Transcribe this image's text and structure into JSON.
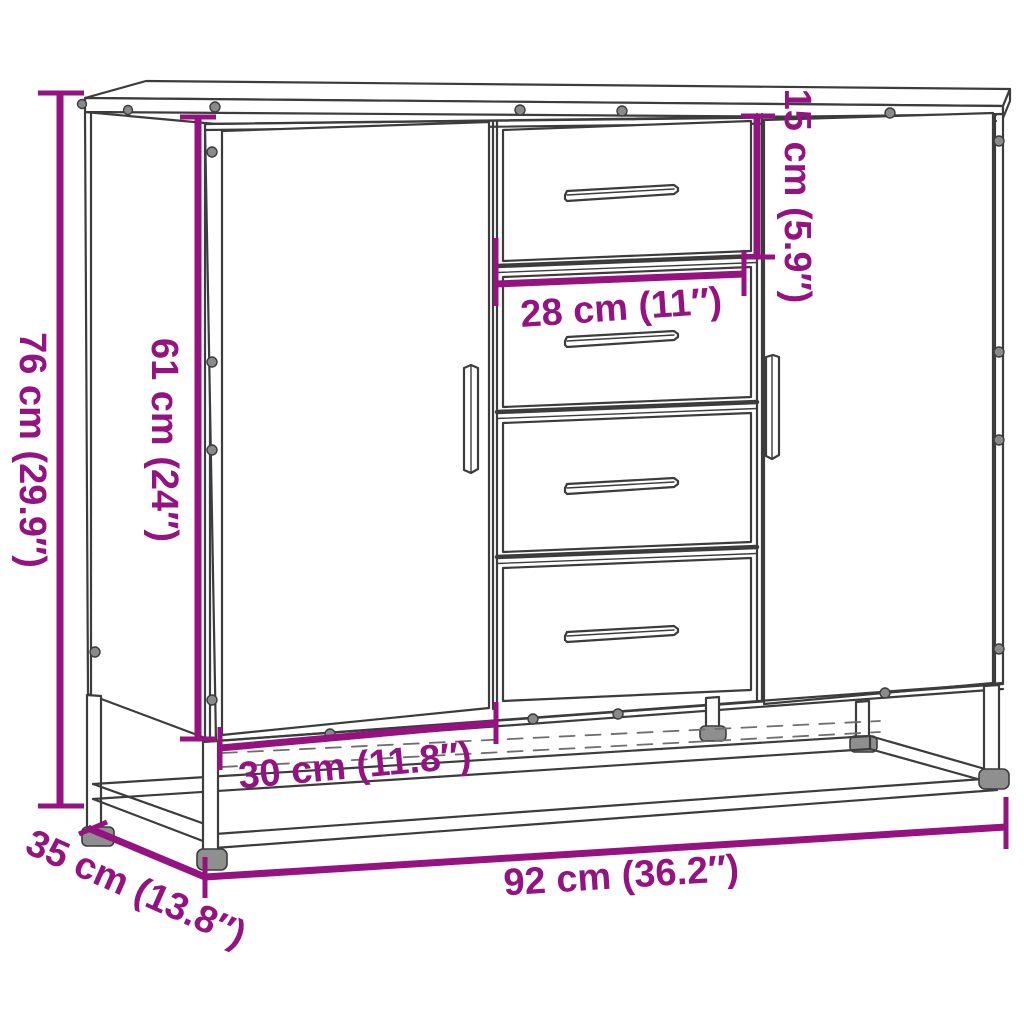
{
  "diagram": {
    "type": "product-dimension-diagram",
    "subject": "sideboard with two doors, four center drawers and metal base frame",
    "background_color": "#FFFFFF",
    "accent_color": "#951281",
    "line_color": "#3C3C3C",
    "dimensions": {
      "overall_height": "76 cm (29.9″)",
      "door_height": "61 cm (24″)",
      "top_drawer_height": "15 cm (5.9″)",
      "drawer_width": "28 cm (11″)",
      "drawer_section_width": "30 cm (11.8″)",
      "overall_width": "92 cm (36.2″)",
      "overall_depth": "35 cm (13.8″)"
    }
  }
}
